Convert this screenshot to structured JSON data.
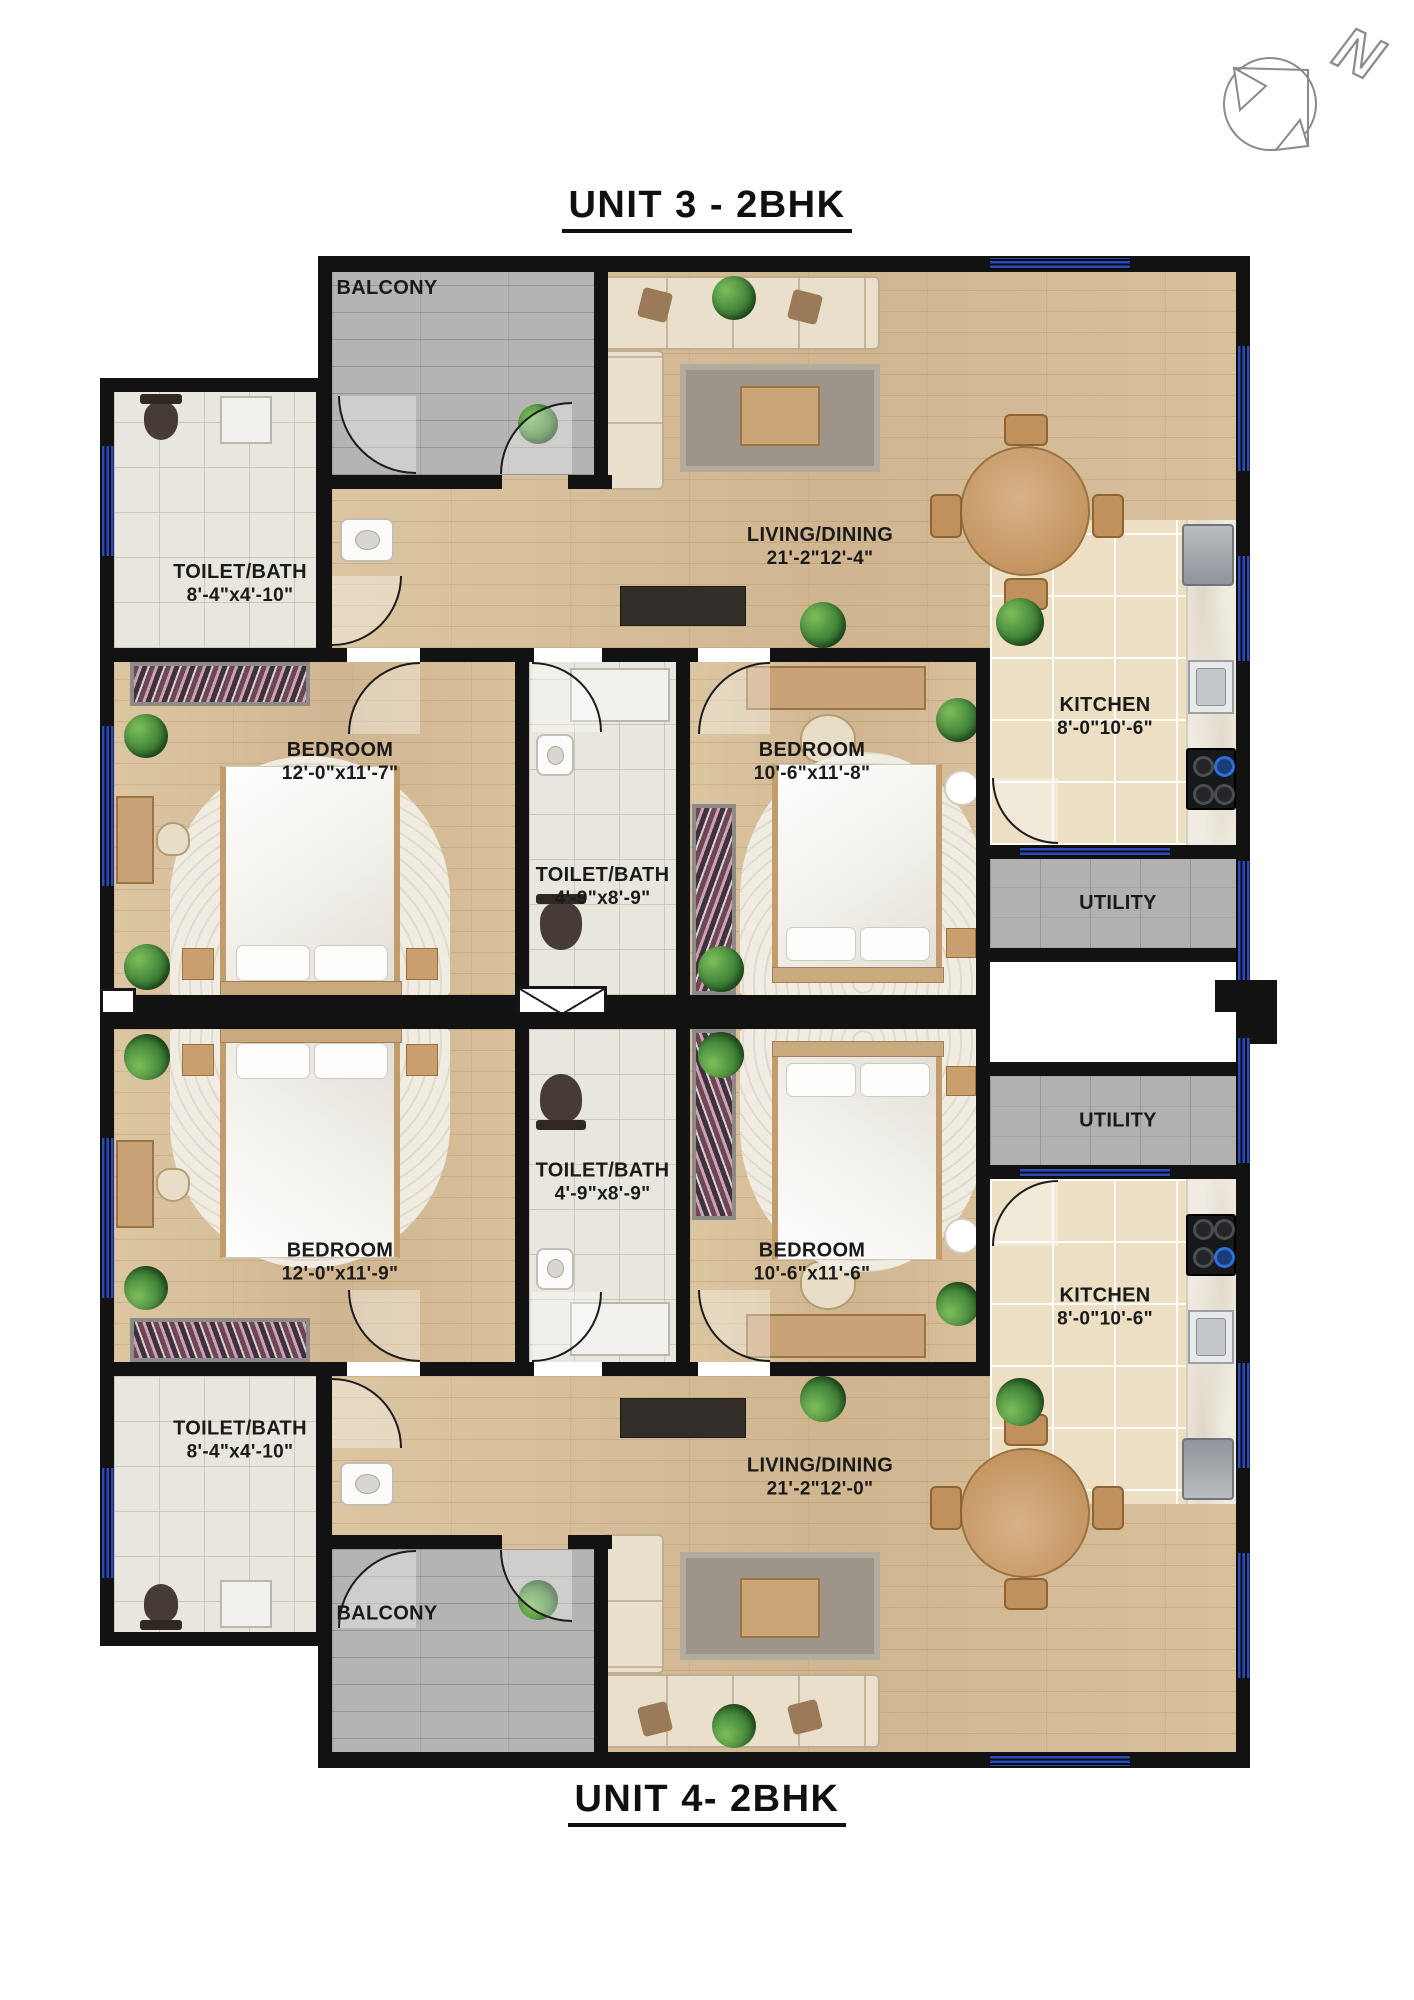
{
  "page": {
    "title_top": "UNIT 3 - 2BHK",
    "title_bottom": "UNIT 4- 2BHK"
  },
  "compass": {
    "label": "N"
  },
  "colors": {
    "wall": "#121212",
    "window_blue": "#2a4bbe",
    "wood_floor": "#d7bf9b",
    "kitchen_tile": "#ecdfc4",
    "toilet_tile": "#e9e6dd",
    "balcony_gray": "#b6b4b2",
    "utility_gray": "#b3b1af",
    "stove_flame_blue": "#2f6fd8"
  },
  "unit3": {
    "balcony": {
      "label": "BALCONY"
    },
    "living": {
      "label": "LIVING/DINING",
      "dims": "21'-2\"12'-4\""
    },
    "kitchen": {
      "label": "KITCHEN",
      "dims": "8'-0\"10'-6\""
    },
    "toilet_left": {
      "label": "TOILET/BATH",
      "dims": "8'-4\"x4'-10\""
    },
    "toilet_mid": {
      "label": "TOILET/BATH",
      "dims": "4'-9\"x8'-9\""
    },
    "bedroom_left": {
      "label": "BEDROOM",
      "dims": "12'-0\"x11'-7\""
    },
    "bedroom_right": {
      "label": "BEDROOM",
      "dims": "10'-6\"x11'-8\""
    },
    "utility": {
      "label": "UTILITY"
    }
  },
  "unit4": {
    "balcony": {
      "label": "BALCONY"
    },
    "living": {
      "label": "LIVING/DINING",
      "dims": "21'-2\"12'-0\""
    },
    "kitchen": {
      "label": "KITCHEN",
      "dims": "8'-0\"10'-6\""
    },
    "toilet_left": {
      "label": "TOILET/BATH",
      "dims": "8'-4\"x4'-10\""
    },
    "toilet_mid": {
      "label": "TOILET/BATH",
      "dims": "4'-9\"x8'-9\""
    },
    "bedroom_left": {
      "label": "BEDROOM",
      "dims": "12'-0\"x11'-9\""
    },
    "bedroom_right": {
      "label": "BEDROOM",
      "dims": "10'-6\"x11'-6\""
    },
    "utility": {
      "label": "UTILITY"
    }
  }
}
